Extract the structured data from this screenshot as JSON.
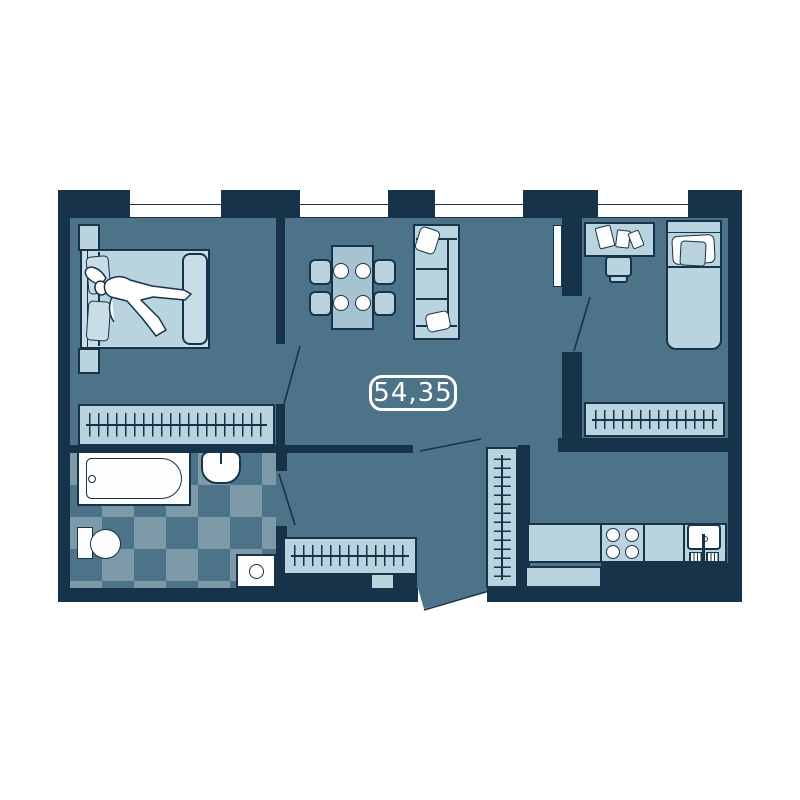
{
  "floorplan": {
    "area_label": "54,35",
    "colors": {
      "wall": "#16334a",
      "floor": "#4d7389",
      "furniture_light": "#b9d3df",
      "furniture_lighter": "#c9dde6",
      "furniture_mid": "#a6c3d2",
      "checker_light": "#7d9aa9",
      "white": "#fdfdfd",
      "background": "#ffffff",
      "label": "#ffffff"
    },
    "windows_count": 4,
    "rooms": [
      {
        "name": "master-bedroom",
        "furniture": [
          "double-bed",
          "person-sleeping",
          "nightstand",
          "nightstand",
          "clothes-rack"
        ]
      },
      {
        "name": "living-dining-room",
        "furniture": [
          "dining-table",
          "four-chairs",
          "four-plates",
          "sofa",
          "two-pillows"
        ]
      },
      {
        "name": "second-bedroom",
        "furniture": [
          "desk",
          "papers",
          "desk-chair",
          "single-bed",
          "clothes-rack"
        ]
      },
      {
        "name": "bathroom",
        "furniture": [
          "bathtub",
          "washbasin",
          "toilet",
          "washing-machine"
        ]
      },
      {
        "name": "hallway",
        "furniture": [
          "clothes-rack-horizontal",
          "clothes-rack-vertical"
        ]
      },
      {
        "name": "kitchen",
        "furniture": [
          "counter",
          "stove-four-burners",
          "kitchen-sink",
          "counter-return"
        ]
      }
    ],
    "doors": [
      "master-bedroom-door",
      "bathroom-door",
      "living-hall-door",
      "second-bedroom-door",
      "entrance-door"
    ]
  }
}
